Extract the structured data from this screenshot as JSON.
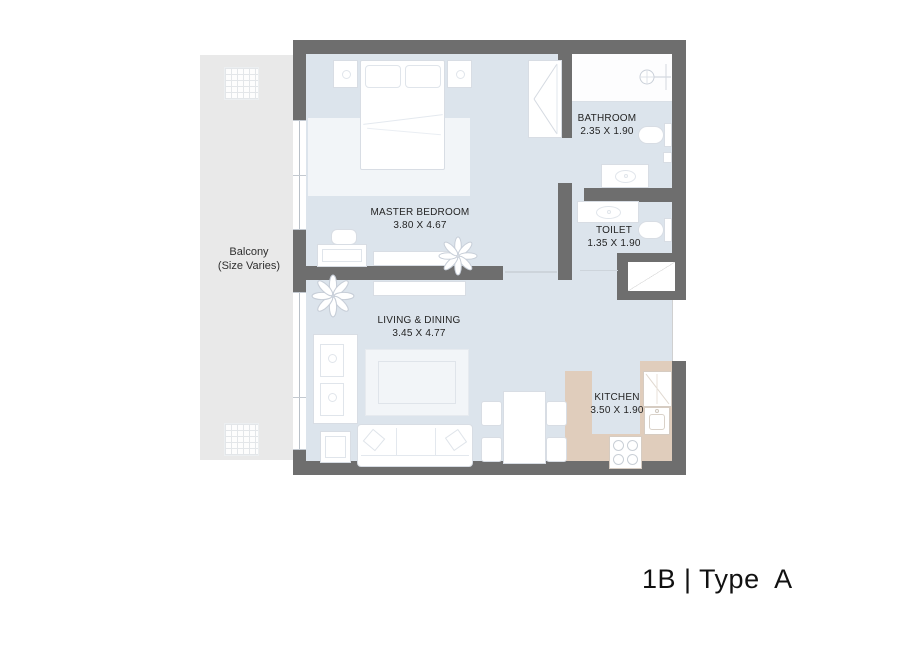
{
  "plan": {
    "title": "1B | Type  A",
    "rooms": {
      "master_bedroom": {
        "name": "MASTER BEDROOM",
        "dims": "3.80 X 4.67"
      },
      "bathroom": {
        "name": "BATHROOM",
        "dims": "2.35 X 1.90"
      },
      "toilet": {
        "name": "TOILET",
        "dims": "1.35 X 1.90"
      },
      "living_dining": {
        "name": "LIVING & DINING",
        "dims": "3.45 X 4.77"
      },
      "kitchen": {
        "name": "KITCHEN",
        "dims": "3.50 X 1.90"
      }
    },
    "balcony": {
      "name": "Balcony",
      "note": "(Size Varies)"
    },
    "colors": {
      "wall": "#6e6e6e",
      "floor": "#dce4ec",
      "balcony": "#e9e9e9",
      "kitchen_counter": "#e0cdbc",
      "furniture": "#ffffff",
      "label_text": "#242424"
    }
  }
}
